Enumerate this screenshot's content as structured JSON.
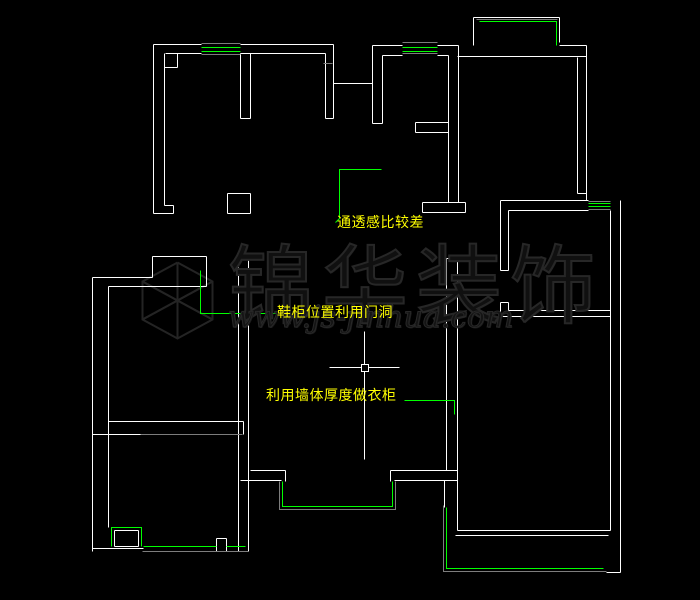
{
  "canvas": {
    "width": 700,
    "height": 600,
    "background": "#000000"
  },
  "colors": {
    "wall": "#ffffff",
    "window": "#00ff00",
    "frame": "#7d7d7d",
    "annotation_text": "#ffff00",
    "leader": "#00ff00",
    "crosshair": "#ffffff",
    "watermark": "#242424"
  },
  "annotations": [
    {
      "text": "通透感比较差",
      "x": 337,
      "y": 216,
      "leader": [
        [
          381,
          169
        ],
        [
          339,
          169
        ],
        [
          339,
          218
        ],
        [
          335,
          222
        ]
      ]
    },
    {
      "text": "鞋柜位置利用门洞",
      "x": 277,
      "y": 306,
      "leader": [
        [
          200,
          270
        ],
        [
          200,
          313
        ],
        [
          276,
          313
        ]
      ]
    },
    {
      "text": "利用墙体厚度做衣柜",
      "x": 266,
      "y": 389,
      "leader": [
        [
          404,
          400
        ],
        [
          454,
          400
        ],
        [
          454,
          414
        ]
      ]
    }
  ],
  "watermark": {
    "title": "锦华装饰",
    "url": "www.js-jinhua.com"
  },
  "crosshair": {
    "cx": 364,
    "cy": 367,
    "h": [
      329,
      399
    ],
    "v": [
      331,
      459
    ],
    "box": 7
  },
  "geometry": {
    "wall_segments": [
      [
        153,
        44,
        201,
        44
      ],
      [
        240,
        44,
        333,
        44
      ],
      [
        165,
        53,
        201,
        53
      ],
      [
        240,
        53,
        325,
        53
      ],
      [
        153,
        44,
        153,
        213
      ],
      [
        164,
        53,
        164,
        205
      ],
      [
        164,
        67,
        177,
        67
      ],
      [
        177,
        53,
        177,
        67
      ],
      [
        153,
        213,
        173,
        213
      ],
      [
        164,
        205,
        173,
        205
      ],
      [
        173,
        205,
        173,
        213
      ],
      [
        227,
        193,
        250,
        193
      ],
      [
        227,
        193,
        227,
        213
      ],
      [
        227,
        213,
        250,
        213
      ],
      [
        250,
        193,
        250,
        213
      ],
      [
        240,
        53,
        240,
        118
      ],
      [
        250,
        53,
        250,
        118
      ],
      [
        240,
        118,
        250,
        118
      ],
      [
        325,
        53,
        325,
        118
      ],
      [
        333,
        44,
        333,
        83
      ],
      [
        325,
        118,
        333,
        118
      ],
      [
        333,
        83,
        333,
        118
      ],
      [
        333,
        83,
        372,
        83
      ],
      [
        372,
        45,
        372,
        123
      ],
      [
        382,
        55,
        382,
        123
      ],
      [
        372,
        123,
        382,
        123
      ],
      [
        372,
        45,
        402,
        45
      ],
      [
        437,
        45,
        458,
        45
      ],
      [
        382,
        55,
        402,
        55
      ],
      [
        437,
        55,
        448,
        55
      ],
      [
        448,
        55,
        448,
        202
      ],
      [
        458,
        45,
        458,
        202
      ],
      [
        422,
        202,
        465,
        202
      ],
      [
        422,
        212,
        465,
        212
      ],
      [
        422,
        202,
        422,
        212
      ],
      [
        465,
        202,
        465,
        212
      ],
      [
        415,
        122,
        448,
        122
      ],
      [
        415,
        132,
        448,
        132
      ],
      [
        415,
        122,
        415,
        132
      ],
      [
        473,
        17,
        559,
        17
      ],
      [
        473,
        17,
        473,
        45
      ],
      [
        559,
        17,
        559,
        42
      ],
      [
        559,
        45,
        586,
        45
      ],
      [
        457,
        56,
        586,
        56
      ],
      [
        577,
        57,
        577,
        193
      ],
      [
        586,
        45,
        586,
        200
      ],
      [
        577,
        193,
        586,
        193
      ],
      [
        500,
        200,
        588,
        200
      ],
      [
        508,
        210,
        588,
        210
      ],
      [
        610,
        210,
        610,
        530
      ],
      [
        620,
        200,
        620,
        572
      ],
      [
        500,
        200,
        500,
        270
      ],
      [
        508,
        210,
        508,
        270
      ],
      [
        500,
        270,
        508,
        270
      ],
      [
        500,
        302,
        500,
        316
      ],
      [
        508,
        302,
        508,
        310
      ],
      [
        500,
        302,
        508,
        302
      ],
      [
        508,
        310,
        610,
        310
      ],
      [
        500,
        316,
        610,
        316
      ],
      [
        238,
        258,
        238,
        551
      ],
      [
        248,
        258,
        248,
        551
      ],
      [
        238,
        258,
        248,
        258
      ],
      [
        446,
        258,
        446,
        470
      ],
      [
        457,
        258,
        457,
        530
      ],
      [
        446,
        258,
        457,
        258
      ],
      [
        446,
        470,
        457,
        470
      ],
      [
        444,
        480,
        444,
        507
      ],
      [
        444,
        480,
        457,
        480
      ],
      [
        457,
        530,
        610,
        530
      ],
      [
        455,
        535,
        608,
        535
      ],
      [
        606,
        572,
        620,
        572
      ],
      [
        92,
        277,
        152,
        277
      ],
      [
        152,
        256,
        152,
        277
      ],
      [
        152,
        256,
        206,
        256
      ],
      [
        206,
        256,
        206,
        286
      ],
      [
        108,
        286,
        206,
        286
      ],
      [
        108,
        286,
        108,
        421
      ],
      [
        92,
        277,
        92,
        551
      ],
      [
        108,
        421,
        243,
        421
      ],
      [
        243,
        421,
        243,
        434
      ],
      [
        108,
        421,
        108,
        434
      ],
      [
        92,
        434,
        140,
        434
      ],
      [
        108,
        434,
        108,
        527
      ],
      [
        92,
        548,
        143,
        548
      ],
      [
        216,
        538,
        226,
        538
      ],
      [
        216,
        538,
        216,
        551
      ],
      [
        226,
        538,
        226,
        551
      ],
      [
        216,
        551,
        226,
        551
      ],
      [
        114,
        530,
        138,
        530
      ],
      [
        114,
        530,
        114,
        546
      ],
      [
        138,
        530,
        138,
        546
      ],
      [
        114,
        546,
        138,
        546
      ],
      [
        250,
        470,
        285,
        470
      ],
      [
        240,
        480,
        281,
        480
      ],
      [
        285,
        470,
        285,
        481
      ],
      [
        390,
        470,
        446,
        470
      ],
      [
        394,
        480,
        444,
        480
      ],
      [
        390,
        470,
        390,
        481
      ]
    ],
    "gray_segments": [
      [
        201,
        43,
        240,
        43
      ],
      [
        201,
        54,
        240,
        54
      ],
      [
        402,
        42,
        437,
        42
      ],
      [
        402,
        53,
        437,
        53
      ],
      [
        476,
        19,
        557,
        19
      ],
      [
        588,
        201,
        610,
        201
      ],
      [
        588,
        209,
        610,
        209
      ],
      [
        140,
        434,
        242,
        434
      ],
      [
        142,
        551,
        248,
        551
      ],
      [
        323,
        63,
        332,
        63
      ]
    ],
    "gray_polylines": [
      [
        [
          279,
          481
        ],
        [
          279,
          509
        ],
        [
          395,
          509
        ],
        [
          395,
          481
        ]
      ],
      [
        [
          443,
          505
        ],
        [
          443,
          571
        ],
        [
          606,
          571
        ]
      ]
    ],
    "green_segments": [
      [
        201,
        47,
        240,
        47
      ],
      [
        201,
        51,
        240,
        51
      ],
      [
        402,
        47,
        437,
        47
      ],
      [
        402,
        51,
        437,
        51
      ],
      [
        588,
        203,
        610,
        203
      ],
      [
        588,
        206,
        610,
        206
      ],
      [
        143,
        546,
        216,
        546
      ],
      [
        226,
        546,
        245,
        546
      ]
    ],
    "green_polylines": [
      [
        [
          479,
          21
        ],
        [
          556,
          21
        ],
        [
          556,
          45
        ]
      ],
      [
        [
          282,
          481
        ],
        [
          282,
          506
        ],
        [
          392,
          506
        ],
        [
          392,
          481
        ]
      ],
      [
        [
          111,
          546
        ],
        [
          111,
          527
        ],
        [
          141,
          527
        ],
        [
          141,
          546
        ]
      ],
      [
        [
          446,
          507
        ],
        [
          446,
          568
        ],
        [
          603,
          568
        ]
      ]
    ],
    "logo_cube": {
      "cx": 177,
      "cy": 300,
      "polylines": [
        [
          [
            177,
            262
          ],
          [
            212,
            281
          ],
          [
            212,
            319
          ],
          [
            177,
            338
          ],
          [
            142,
            319
          ],
          [
            142,
            281
          ],
          [
            177,
            262
          ]
        ],
        [
          [
            177,
            262
          ],
          [
            177,
            338
          ]
        ],
        [
          [
            142,
            281
          ],
          [
            212,
            319
          ]
        ],
        [
          [
            212,
            281
          ],
          [
            142,
            319
          ]
        ],
        [
          [
            142,
            281
          ],
          [
            177,
            300
          ],
          [
            212,
            281
          ]
        ],
        [
          [
            142,
            319
          ],
          [
            177,
            300
          ],
          [
            212,
            319
          ]
        ]
      ]
    }
  }
}
